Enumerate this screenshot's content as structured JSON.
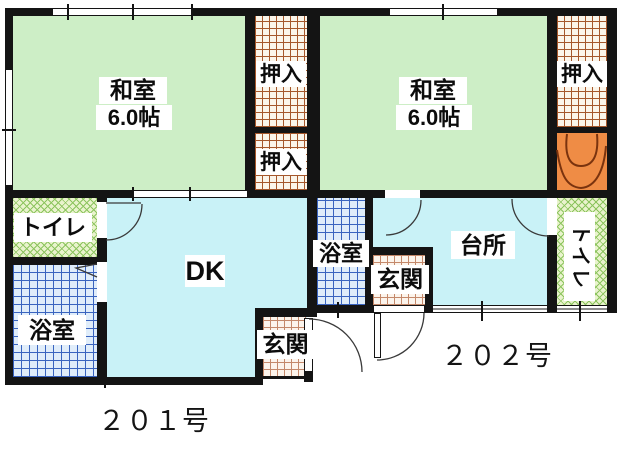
{
  "units": [
    {
      "unit_label": "２０１号",
      "rooms": {
        "washitsu": {
          "name": "和室",
          "size": "6.0帖"
        },
        "oshiire_upper": {
          "name": "押入"
        },
        "oshiire_lower": {
          "name": "押入"
        },
        "toilet": {
          "name": "トイレ"
        },
        "bath": {
          "name": "浴室"
        },
        "dining_kitchen": {
          "name": "DK"
        },
        "entry": {
          "name": "玄関"
        }
      }
    },
    {
      "unit_label": "２０２号",
      "rooms": {
        "washitsu": {
          "name": "和室",
          "size": "6.0帖"
        },
        "oshiire": {
          "name": "押入"
        },
        "bath": {
          "name": "浴室"
        },
        "entry": {
          "name": "玄関"
        },
        "kitchen": {
          "name": "台所"
        },
        "toilet": {
          "name": "トイレ"
        }
      }
    }
  ],
  "colors": {
    "tatami_green": "#cdeec6",
    "water_rooms_cyan": "#c9f2f7",
    "closet_grid_brown": "#a5572b",
    "entry_grid_pink": "#c4886a",
    "toilet_hatch_green": "#8cc45e",
    "bath_grid_blue": "#3a64bf",
    "stairs_orange": "#ef8c45",
    "wall_black": "#141414"
  }
}
